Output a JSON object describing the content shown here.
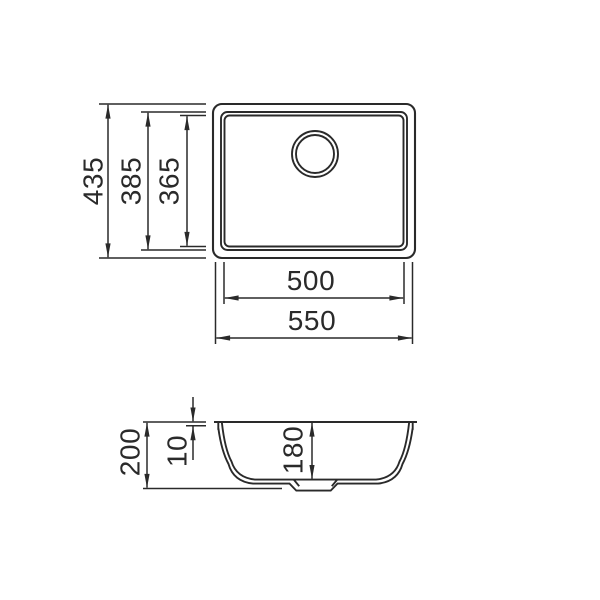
{
  "drawing": {
    "subject": "undermount-sink-dimension-drawing",
    "background_color": "#ffffff",
    "line_color": "#2a2a2a"
  },
  "top_view": {
    "label_height_overall": "435",
    "label_height_rim": "385",
    "label_height_bowl": "365",
    "label_width_bowl": "500",
    "label_width_overall": "550"
  },
  "side_view": {
    "label_depth_overall": "200",
    "label_rim_thickness": "10",
    "label_bowl_depth": "180"
  }
}
